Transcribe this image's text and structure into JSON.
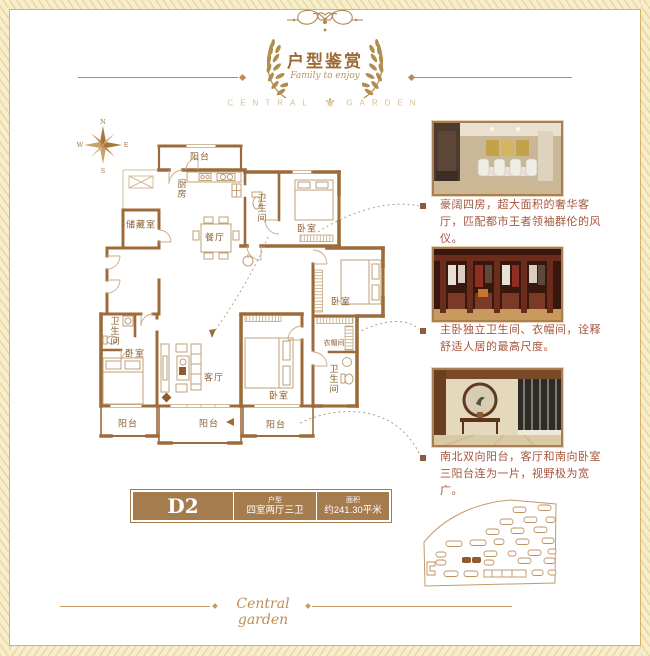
{
  "colors": {
    "accent": "#9c6a35",
    "wall": "#9d6b3a",
    "caption_text": "#a4543c",
    "gold": "#b08c4f",
    "table_bg": "#a57c4e",
    "border_line": "#d8b169"
  },
  "header": {
    "title": "户型鉴赏",
    "subtitle": "Family to enjoy",
    "brand_left": "CENTRAL",
    "brand_right": "GARDEN"
  },
  "compass": {
    "n": "N",
    "e": "E",
    "s": "S",
    "w": "W"
  },
  "floorplan": {
    "rooms": [
      {
        "id": "balcony-top",
        "label": "阳台"
      },
      {
        "id": "kitchen",
        "label": "厨房"
      },
      {
        "id": "bath-north",
        "label": "卫生间"
      },
      {
        "id": "bedroom-north",
        "label": "卧室"
      },
      {
        "id": "storage",
        "label": "储藏室"
      },
      {
        "id": "dining",
        "label": "餐厅"
      },
      {
        "id": "bedroom-east",
        "label": "卧室"
      },
      {
        "id": "bath-west",
        "label": "卫生间"
      },
      {
        "id": "bedroom-west",
        "label": "卧室"
      },
      {
        "id": "living",
        "label": "客厅"
      },
      {
        "id": "cloakroom",
        "label": "衣帽间"
      },
      {
        "id": "bath-south",
        "label": "卫生间"
      },
      {
        "id": "bedroom-master",
        "label": "卧室"
      },
      {
        "id": "balcony-southwest",
        "label": "阳台"
      },
      {
        "id": "balcony-south",
        "label": "阳台"
      },
      {
        "id": "balcony-southeast",
        "label": "阳台"
      }
    ]
  },
  "photos": [
    {
      "caption": "豪阔四房，超大面积的奢华客厅，匹配都市王者领袖群伦的风仪。"
    },
    {
      "caption": "主卧独立卫生间、衣帽间，诠释舒适人居的最高尺度。"
    },
    {
      "caption": "南北双向阳台，客厅和南向卧室三阳台连为一片，视野极为宽广。"
    }
  ],
  "info": {
    "model": "D2",
    "type_label": "户型",
    "type_value": "四室两厅三卫",
    "area_label": "面积",
    "area_value": "约241.30平米"
  },
  "footer": {
    "script": "Central garden"
  }
}
